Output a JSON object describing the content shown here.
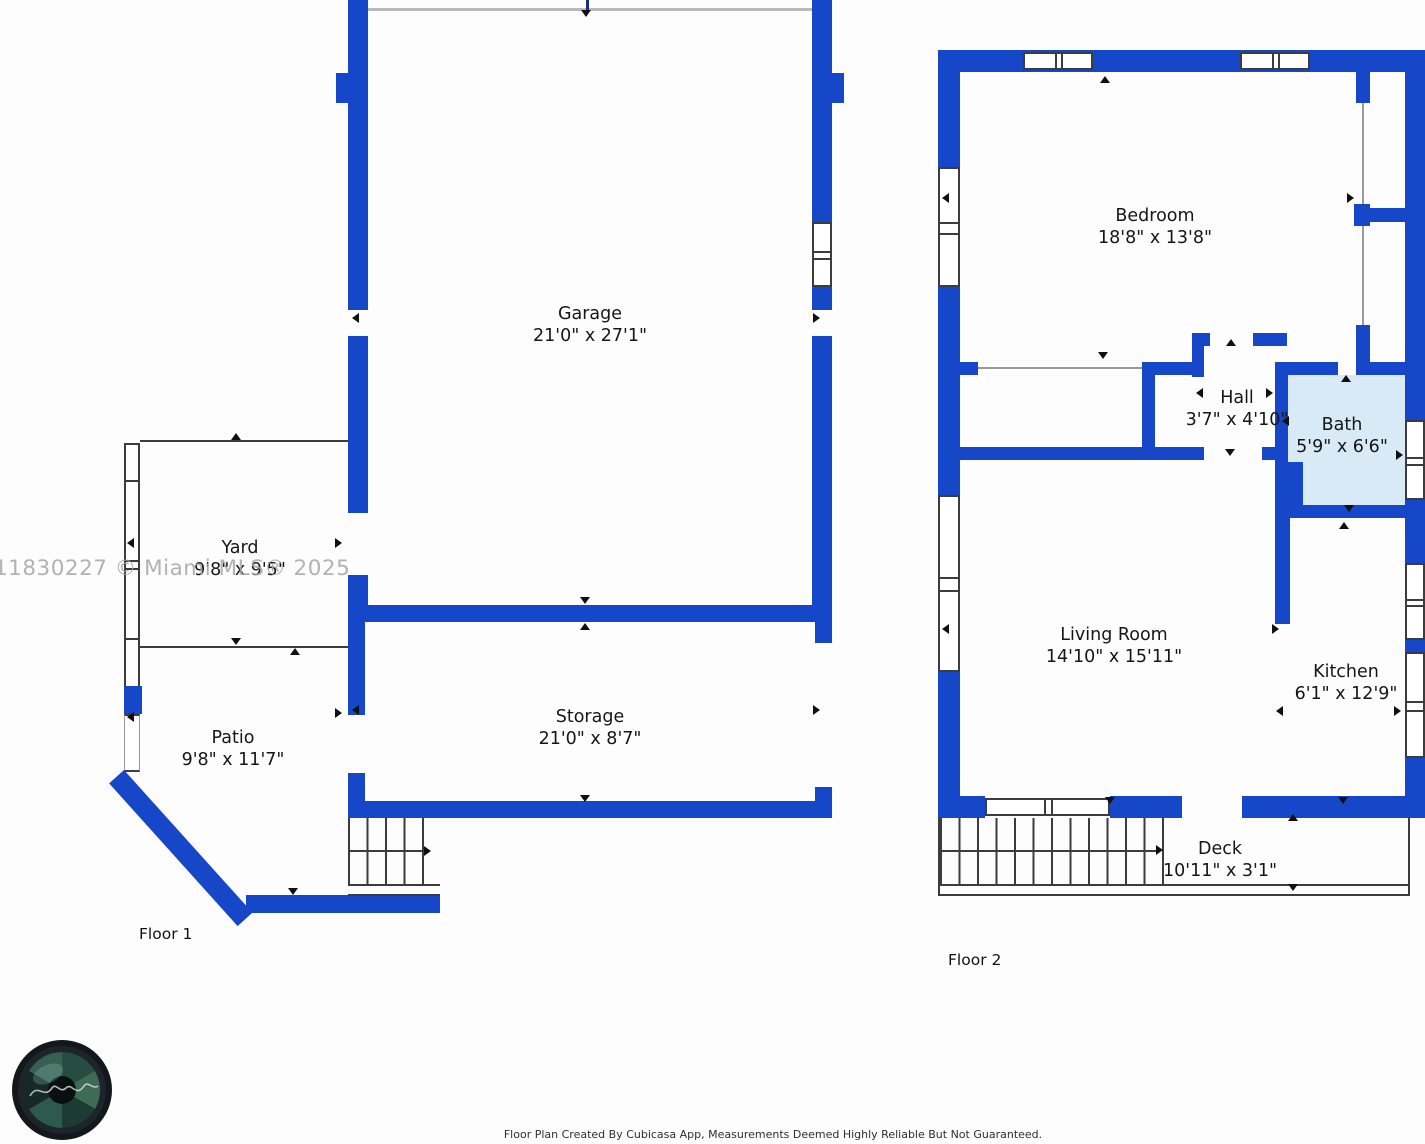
{
  "watermark": {
    "text": "11830227 © Miami MLS® 2025"
  },
  "floors": [
    {
      "label": "Floor 1",
      "rooms": [
        {
          "name": "Garage",
          "dims": "21'0\" x 27'1\""
        },
        {
          "name": "Yard",
          "dims": "9'8\" x 9'5\""
        },
        {
          "name": "Patio",
          "dims": "9'8\" x 11'7\""
        },
        {
          "name": "Storage",
          "dims": "21'0\" x 8'7\""
        }
      ]
    },
    {
      "label": "Floor 2",
      "rooms": [
        {
          "name": "Bedroom",
          "dims": "18'8\" x 13'8\""
        },
        {
          "name": "Hall",
          "dims": "3'7\" x 4'10\""
        },
        {
          "name": "Bath",
          "dims": "5'9\" x 6'6\""
        },
        {
          "name": "Living Room",
          "dims": "14'10\" x 15'11\""
        },
        {
          "name": "Kitchen",
          "dims": "6'1\" x 12'9\""
        },
        {
          "name": "Deck",
          "dims": "10'11\" x 3'1\""
        }
      ]
    }
  ],
  "footer": {
    "disclaimer": "Floor Plan Created By Cubicasa App, Measurements Deemed Highly Reliable But Not Guaranteed."
  },
  "colors": {
    "wall_blue": "#1747c9",
    "bath_fill": "#d9eaf7",
    "watermark_gray": "#a6a6a6"
  }
}
